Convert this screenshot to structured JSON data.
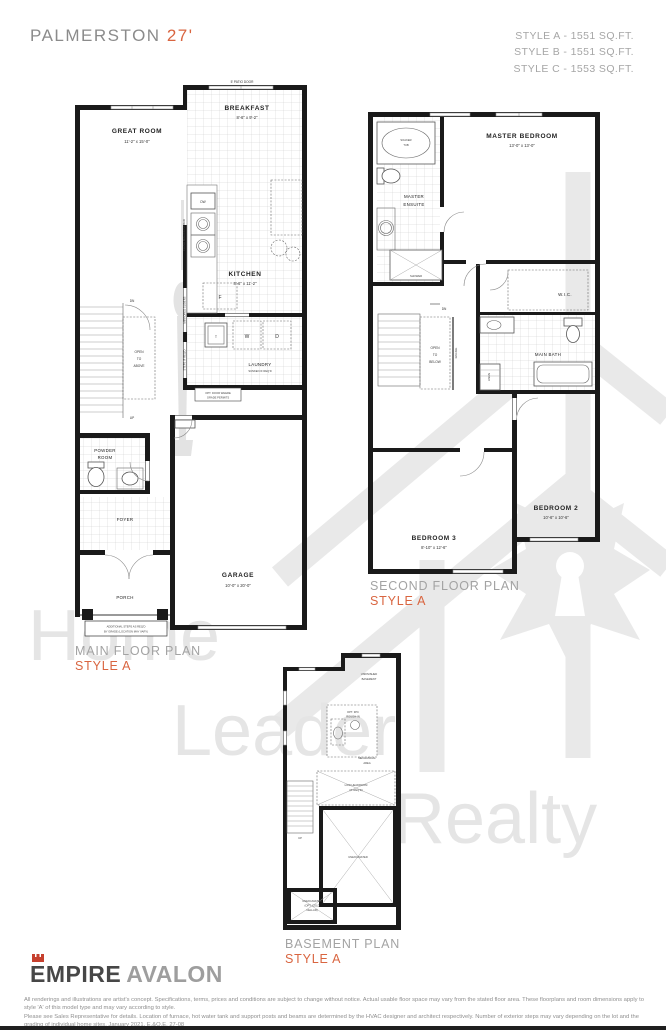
{
  "header": {
    "model_name": "PALMERSTON",
    "model_width": "27'",
    "styles": [
      "STYLE A - 1551 SQ.FT.",
      "STYLE B - 1551 SQ.FT.",
      "STYLE C - 1553 SQ.FT."
    ]
  },
  "watermark": {
    "words": [
      "Home",
      "Leader",
      "Realty"
    ]
  },
  "captions": {
    "main": {
      "title": "MAIN FLOOR PLAN",
      "style": "STYLE A"
    },
    "second": {
      "title": "SECOND FLOOR PLAN",
      "style": "STYLE A"
    },
    "basement": {
      "title": "BASEMENT PLAN",
      "style": "STYLE A"
    }
  },
  "main_floor": {
    "patio_door": "5' PATIO DOOR",
    "great_room": {
      "name": "GREAT ROOM",
      "dims": "11'-2\" x 15'-0\""
    },
    "breakfast": {
      "name": "BREAKFAST",
      "dims": "8'-6\" x 9'-2\""
    },
    "kitchen": {
      "name": "KITCHEN",
      "dims": "8'-6\" x 11'-2\""
    },
    "dw": "DW",
    "fridge": "F",
    "tub": "T",
    "washer": "W",
    "dryer": "D",
    "flush_breakfast_bar": "FLUSH BREAKFAST BAR",
    "mirrored_sliders": "MIRRORED SLIDERS",
    "steps_if_reqd": "STEPS IF REQ'D",
    "dn": "DN",
    "up": "UP",
    "open_to_above": [
      "OPEN",
      "TO",
      "ABOVE"
    ],
    "laundry": {
      "name": "LAUNDRY",
      "note": "SUNKEN IF REQ'D"
    },
    "opt_door": [
      "OPT. DOOR WHERE",
      "GRADE PERMITS"
    ],
    "powder_room": [
      "POWDER",
      "ROOM"
    ],
    "foyer": "FOYER",
    "garage": {
      "name": "GARAGE",
      "dims": "10'-0\" x 20'-0\""
    },
    "porch": "PORCH",
    "additional_steps": [
      "ADDITIONAL STEPS AS REQ'D",
      "BY GRADE (LOCATION MAY VARY)"
    ]
  },
  "second_floor": {
    "soaker_tub": [
      "SOAKER",
      "TUB"
    ],
    "master_bedroom": {
      "name": "MASTER BEDROOM",
      "dims": "13'-0\" x 13'-0\""
    },
    "master_ensuite": [
      "MASTER",
      "ENSUITE"
    ],
    "shower": "SHOWER",
    "wic": "W.I.C.",
    "main_bath": "MAIN BATH",
    "linen": "LINEN",
    "dn": "DN",
    "open_to_below": [
      "OPEN",
      "TO",
      "BELOW"
    ],
    "railing": "RAILING",
    "bedroom2": {
      "name": "BEDROOM 2",
      "dims": "10'-6\" x 10'-6\""
    },
    "bedroom3": {
      "name": "BEDROOM 3",
      "dims": "8'-10\" x 12'-6\""
    }
  },
  "basement": {
    "unfinished": [
      "UNFINISHED",
      "BASEMENT"
    ],
    "rough_in": [
      "OPT. 3PC",
      "ROUGH-IN"
    ],
    "mechanical": [
      "MECHANICAL",
      "AREA"
    ],
    "low_headroom": [
      "LOW HEADROOM",
      "(IF REQ'D)"
    ],
    "up": "UP",
    "unexcavated": "UNEXCAVATED",
    "cold_cellar": [
      "UNEXCAVATED",
      "(OPT. COLD",
      "CELLAR)"
    ]
  },
  "footer": {
    "brand_primary": "EMPIRE",
    "brand_secondary": "AVALON",
    "disclaimer_line1": "All renderings and illustrations are artist's concept. Specifications, terms, prices and conditions are subject to change without notice. Actual usable floor space may vary from the stated floor area. These floorplans and room dimensions apply to style 'A' of this model type and may vary according to style.",
    "disclaimer_line2": "Please see Sales Representative for details. Location of furnace, hot water tank and support posts and beams are determined by the HVAC designer and architect respectively. Number of exterior steps may vary depending on the lot and the grading of individual home sites. January 2021. E.&O.E. 27-08"
  },
  "colors": {
    "accent": "#d96540",
    "crown": "#c6402e",
    "wall": "#1a1a1a",
    "caption_gray": "#a3a3a3",
    "watermark_gray": "#e5e5e5"
  }
}
